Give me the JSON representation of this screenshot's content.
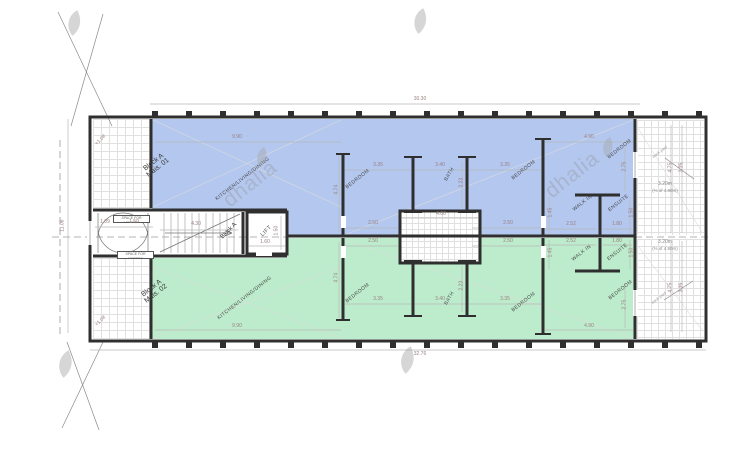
{
  "watermark": {
    "brand": "dhalia"
  },
  "plan": {
    "flat1": {
      "line1": "Block A",
      "line2": "Mais. 01"
    },
    "flat2": {
      "line1": "Block A",
      "line2": "Mais. 02"
    },
    "labels": {
      "kitchen": "KITCHEN/LIVING/DINING",
      "bedroom": "BEDROOM",
      "bath": "BATH",
      "walk_in": "WALK IN",
      "ensuite": "ENSUITE",
      "lift": "LIFT",
      "stair_block": "Block A",
      "meters": "SPACE FOR METERS",
      "terrace_level": "+1.08",
      "yard_line1": "3.20m",
      "yard_line2": "(⅔ of 4.80m)",
      "yard_note": "back yard"
    },
    "dims": {
      "overall_top": "30.30",
      "overall_bottom": "32.76",
      "overall_left": "11.08",
      "kitchen_w": "9.90",
      "bed3_w": "4.90",
      "bed3_h": "2.75",
      "bed1_w": "3.35",
      "bath_w": "3.40",
      "bed2_w": "3.35",
      "room_d": "4.74",
      "bed_back": "2.50",
      "shaft_w": "4.00",
      "bath_d": "2.23",
      "hall_a": "1.09",
      "hall_b": "1.50",
      "stair_w": "4.30",
      "lift_w": "1.60",
      "lift_d": "1.50",
      "walkin_w": "2.52",
      "ensuite_w": "1.80",
      "walkin_d": "1.45",
      "ensuite_d": "1.50",
      "yard_a": "4.75",
      "yard_b": "3.35"
    },
    "colors": {
      "flat1_fill": "#b3c7ef",
      "flat2_fill": "#bdeccc",
      "wall": "#2f2f2f",
      "dim_text": "#9a7f7f",
      "watermark": "#d2d2d2"
    }
  }
}
